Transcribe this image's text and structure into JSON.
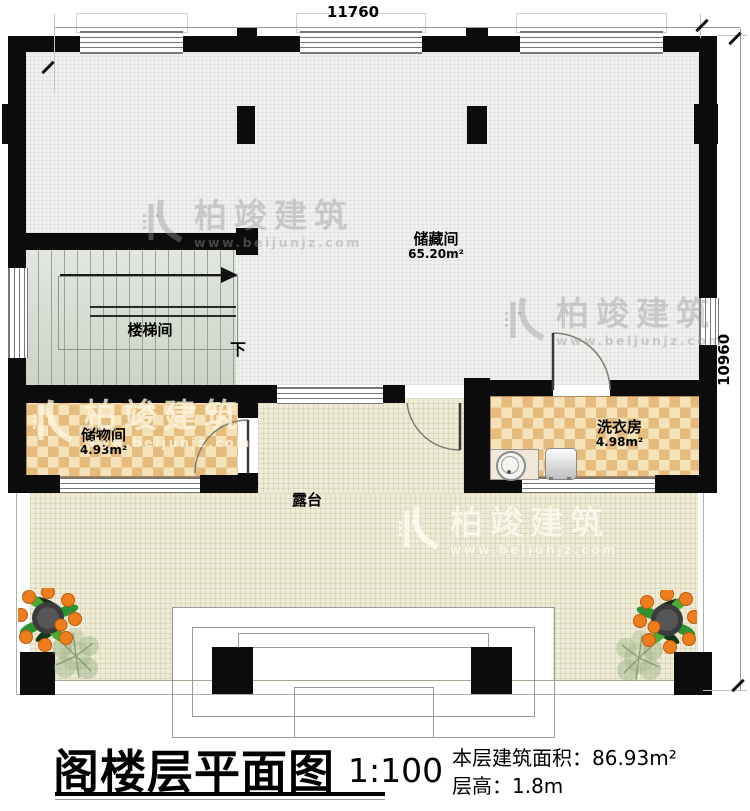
{
  "dimensions": {
    "top": "11760",
    "right": "10960"
  },
  "rooms": {
    "storage": {
      "name": "储藏间",
      "area": "65.20m²"
    },
    "stairwell": {
      "name": "楼梯间",
      "direction_down": "下"
    },
    "closet": {
      "name": "储物间",
      "area": "4.93m²"
    },
    "laundry": {
      "name": "洗衣房",
      "area": "4.98m²"
    },
    "terrace": {
      "name": "露台"
    }
  },
  "title_block": {
    "title": "阁楼层平面图",
    "scale": "1:100",
    "area_label": "本层建筑面积：",
    "area_value": "86.93m²",
    "height_label": "层高：",
    "height_value": "1.8m"
  },
  "watermark": {
    "brand": "柏竣建筑",
    "site": "www.beijunjz.com"
  },
  "colors": {
    "wall": "#0c0c0c",
    "tile_dark": "#e5bc7e",
    "tile_light": "#f6e2b8",
    "terrace_floor": "#eeebd6",
    "stair_floor": "#dfe3dc",
    "storage_floor": "#eff1ef"
  }
}
